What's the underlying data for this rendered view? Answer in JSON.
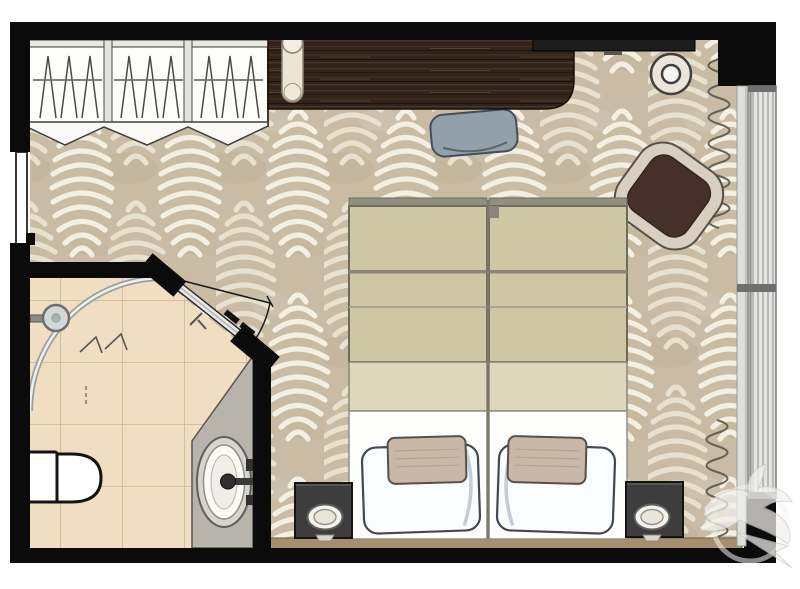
{
  "meta": {
    "title": "Hotel guest room floor plan",
    "view": "top-down 2D architectural rendering",
    "text_on_screen": "none"
  },
  "colors": {
    "page_bg": "#ffffff",
    "wall": "#0b0b0b",
    "carpet_base": "#cabca4",
    "carpet_leaf": "#e9e1cf",
    "carpet_leaf_alt": "#f4efe3",
    "tile": "#f0ddc2",
    "grout": "#ccb695",
    "wood": "#31221a",
    "duvet": "#cdc7a4",
    "duvet_fold": "#ddd7bb",
    "sheet": "#fdfdfc",
    "pillow": "#fbfcfd",
    "pillow_shadow": "#c3cdd6",
    "cushion": "#c9b8a7",
    "nightstand": "#3d3d3d",
    "headboard": "#a68f6e",
    "desk_chair": "#91a0ab",
    "armchair_seat": "#46312a",
    "armchair_frame": "#d8cfc0",
    "vanity": "#b8b4ac",
    "window_panel": "#e4e4e2",
    "window_frame": "#6f6f6f",
    "curtain_line": "#57574a",
    "glass": "#98a09f",
    "tv": "#1d1d1d"
  },
  "rooms": {
    "bedroom": {
      "label": "Bedroom",
      "furniture": [
        "wardrobe with 3 sections and hanging rails",
        "bi-fold wardrobe doors",
        "long dark-wood desk console",
        "bolster cushion on console",
        "desk chair",
        "wall-mounted TV",
        "round side table",
        "lounge armchair",
        "two twin beds pushed together",
        "two pillows with accent cushions",
        "two nightstands with table lamps",
        "upholstered headboard strip",
        "full-height window with mullions",
        "curtains drawn open at top and bottom of window"
      ]
    },
    "bathroom": {
      "label": "Bathroom",
      "fixtures": [
        "curved walk-in shower glass screen",
        "wall-mounted shower head",
        "wall-hung toilet",
        "vanity counter with oval sink",
        "faucet and wall brackets",
        "diagonal hinged entry door with swing arc"
      ]
    }
  },
  "doors": {
    "entry_door": "room entry door on left wall",
    "bathroom_door": "glass door on diagonal wall with swing arc"
  },
  "counts": {
    "wardrobe_sections": 3,
    "beds": 2,
    "pillows": 2,
    "accent_cushions": 2,
    "nightstands": 2,
    "lamps": 2
  },
  "watermark": {
    "icon": "swallow-bird-logo",
    "position": "bottom-right corner"
  }
}
